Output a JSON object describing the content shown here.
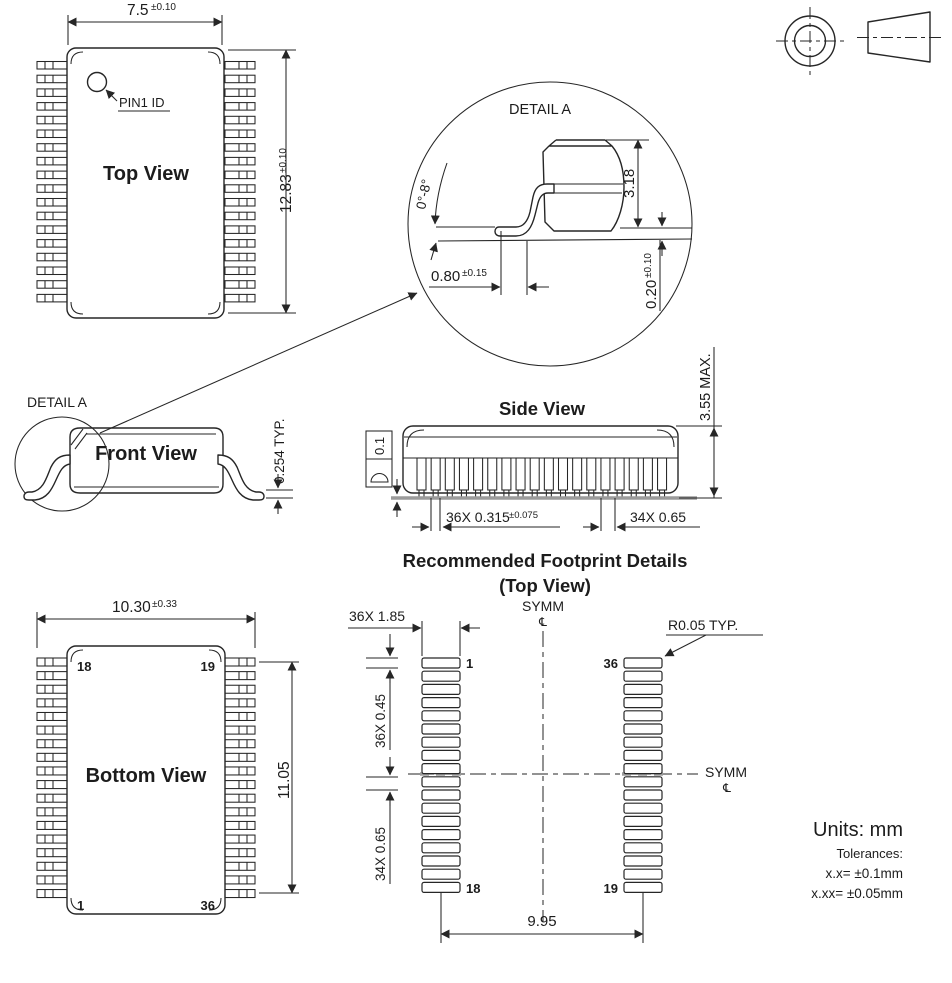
{
  "top_view": {
    "title": "Top View",
    "pin1_label": "PIN1 ID",
    "width": {
      "value": "7.5",
      "tol": "±0.10"
    },
    "height": {
      "value": "12.83",
      "tol": "±0.10"
    }
  },
  "detail_a": {
    "title": "DETAIL A",
    "lead_angle": "0°-8°",
    "body_height": "3.18",
    "foot_length": {
      "value": "0.80",
      "tol": "±0.15"
    },
    "standoff": {
      "value": "0.20",
      "tol": "±0.10"
    }
  },
  "front_view": {
    "title": "Front View",
    "detail_callout": "DETAIL A",
    "lead_thickness": "0.254 TYP."
  },
  "side_view": {
    "title": "Side View",
    "coplanarity": "0.1",
    "max_height": "3.55 MAX.",
    "lead_width": {
      "value": "36X 0.315",
      "tol": "±0.075"
    },
    "lead_pitch": "34X 0.65"
  },
  "footprint": {
    "title_line1": "Recommended Footprint Details",
    "title_line2": "(Top View)",
    "pad_width": "36X 1.85",
    "pad_length": "36X 0.45",
    "pad_pitch": "34X 0.65",
    "pad_span": "9.95",
    "corner_radius": "R0.05 TYP.",
    "symm_top": "SYMM",
    "symm_right": "SYMM",
    "centerline_symbol": "℄",
    "pin1": "1",
    "pin18": "18",
    "pin19": "19",
    "pin36": "36"
  },
  "bottom_view": {
    "title": "Bottom View",
    "width": {
      "value": "10.30",
      "tol": "±0.33"
    },
    "lead_span": "11.05",
    "pin_tl": "18",
    "pin_tr": "19",
    "pin_bl": "1",
    "pin_br": "36"
  },
  "notes": {
    "units": "Units: mm",
    "tolerance_heading": "Tolerances:",
    "tolerance_1": "x.x= ±0.1mm",
    "tolerance_2": "x.xx= ±0.05mm"
  }
}
